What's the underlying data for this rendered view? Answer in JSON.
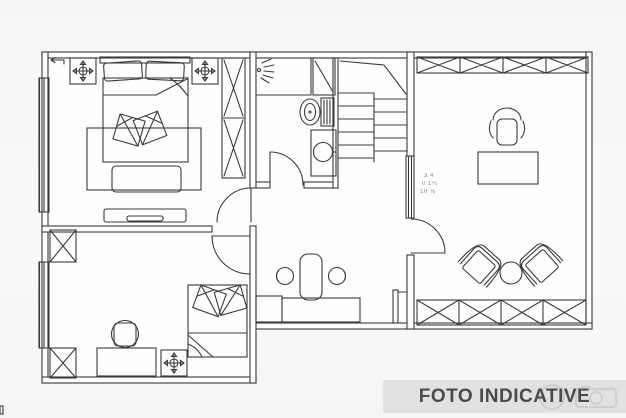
{
  "image": {
    "type": "architectural-floor-plan",
    "style": "black and white top-view line drawing (scan)"
  },
  "watermark": {
    "label": "FOTO INDICATIVE",
    "icon": "camera-icon"
  },
  "annotations": {
    "dim_line_1": "3 4",
    "dim_line_2": "0 1¼",
    "dim_line_3": "10 ⅛"
  },
  "colors": {
    "paper": "#f7f6f4",
    "ink": "#3a3a3a",
    "banner_bg": "#e2e1df",
    "banner_text": "#4b4b4b",
    "rug_fill": "#e3e2de",
    "bench_fill": "#686868"
  },
  "rooms": [
    {
      "id": "bedroom-top-left",
      "furniture": [
        "double-bed",
        "headboard-pillows",
        "throw-pillows",
        "area-rug",
        "storage-bench",
        "wardrobe",
        "tv-cabinet",
        "ceiling-light-symbol",
        "ceiling-light-symbol",
        "window",
        "door"
      ]
    },
    {
      "id": "bathroom",
      "furniture": [
        "shower-spray-symbol",
        "shower-enclosure",
        "toilet",
        "washbasin",
        "door"
      ]
    },
    {
      "id": "staircase",
      "furniture": [
        "stair-treads",
        "break-line"
      ]
    },
    {
      "id": "study-right",
      "furniture": [
        "wardrobe-row-top",
        "wardrobe-row-bottom",
        "office-chair",
        "desk",
        "armchair",
        "armchair",
        "round-side-table",
        "radiator",
        "door",
        "dimension-note"
      ]
    },
    {
      "id": "bedroom-bottom-left",
      "furniture": [
        "single-bed",
        "throw-pillows",
        "office-chair",
        "desk",
        "ceiling-light-symbol",
        "wardrobe-column",
        "wardrobe-column",
        "window",
        "door"
      ]
    },
    {
      "id": "hallway",
      "furniture": [
        "desk",
        "side-desk",
        "chair",
        "stool",
        "stool"
      ]
    }
  ]
}
